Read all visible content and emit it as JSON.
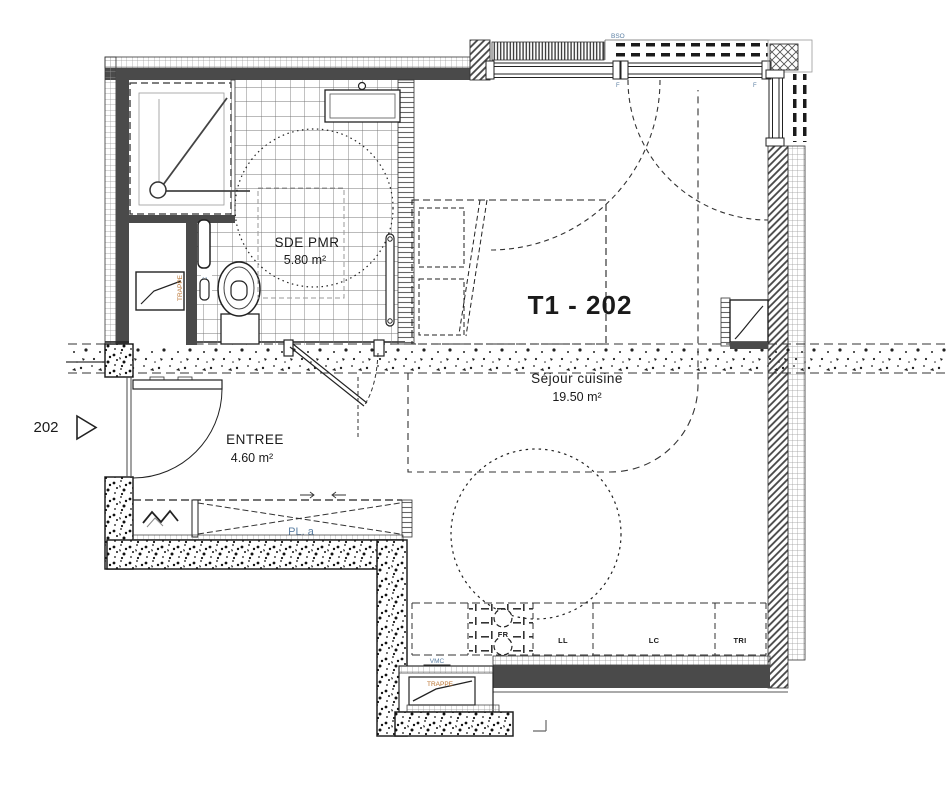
{
  "unit": {
    "title": "T1 - 202"
  },
  "door": {
    "number": "202"
  },
  "rooms": {
    "bathroom": {
      "name": "SDE PMR",
      "area": "5.80 m²"
    },
    "entry": {
      "name": "ENTREE",
      "area": "4.60 m²"
    },
    "living": {
      "name": "Séjour cuisine",
      "area": "19.50 m²"
    }
  },
  "closet": {
    "label": "PL. a"
  },
  "fixtures": {
    "bath_trappe": "TRAPPE",
    "bath_vmc": "VMC",
    "kitchen_vmc": "VMC",
    "kitchen_trappe": "TRAPPE",
    "bso": "BSO",
    "window_tag_left": "F",
    "window_tag_right": "F"
  },
  "appliances": {
    "fr": "FR",
    "ll": "LL",
    "lc": "LC",
    "tri": "TRI"
  },
  "colors": {
    "label_blue": "#5b7fa3",
    "label_orange": "#b9722f",
    "wall": "#4a4a4a",
    "line": "#222222"
  }
}
